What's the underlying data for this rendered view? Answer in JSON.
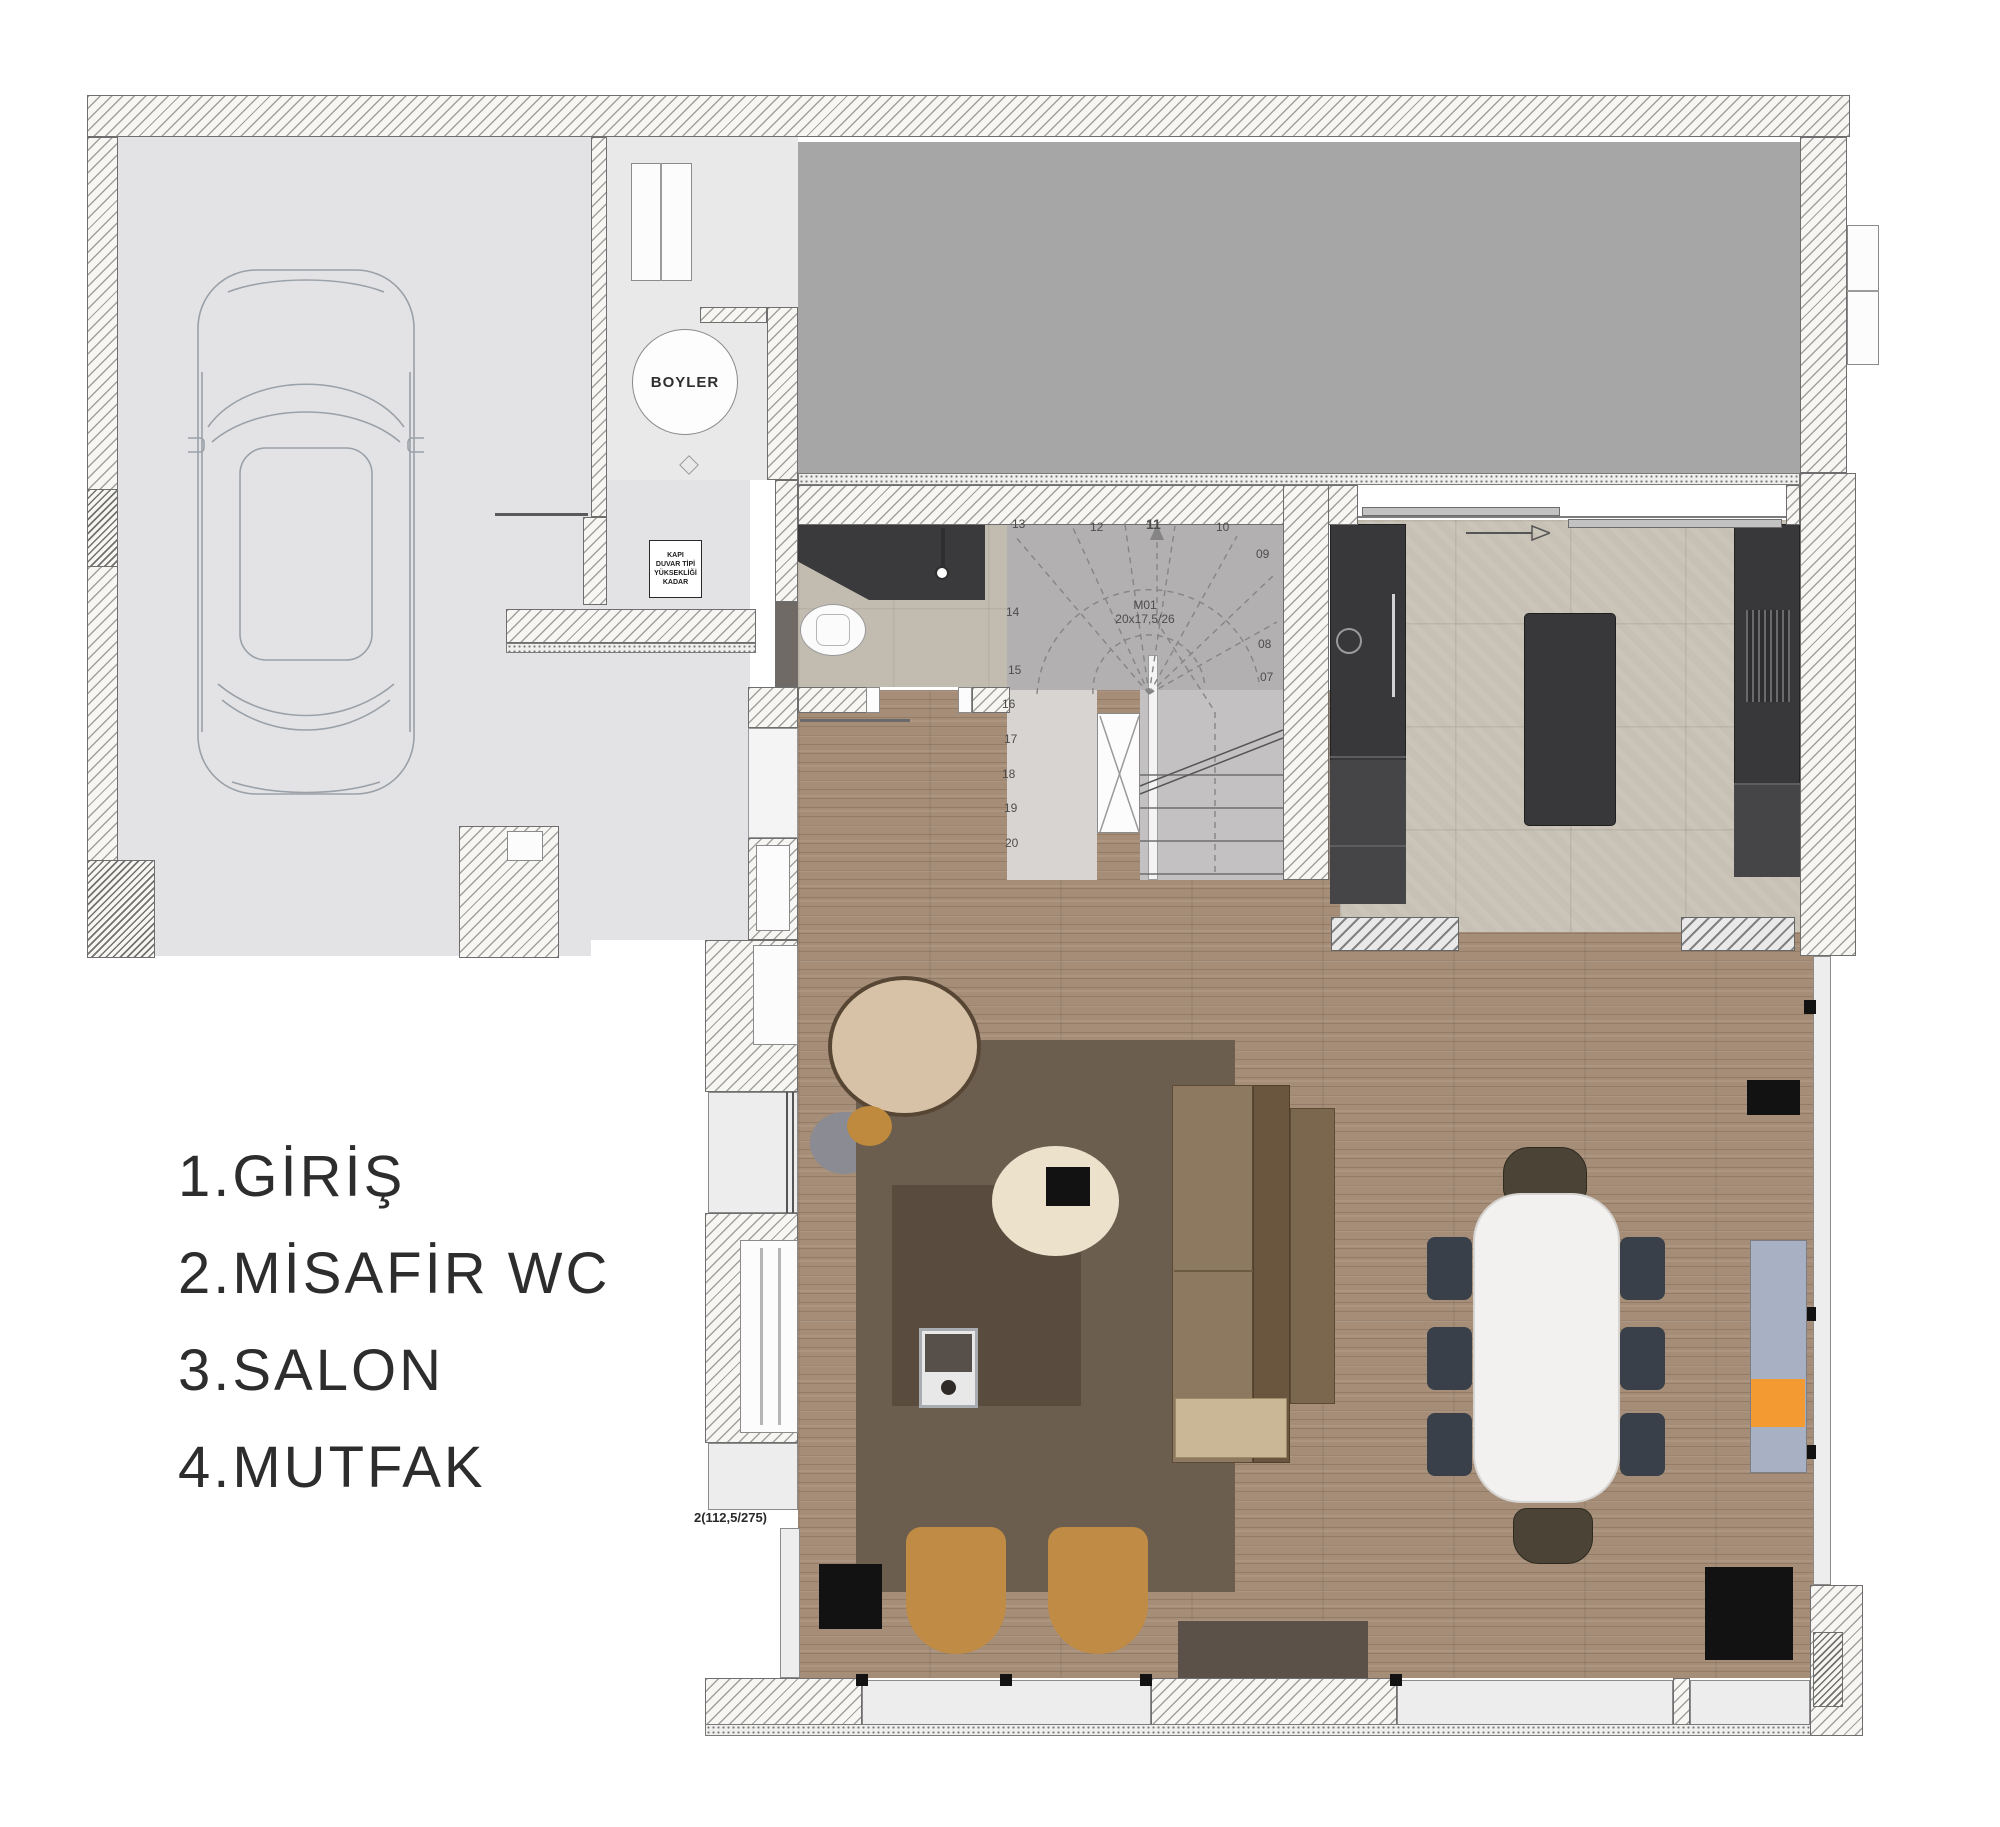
{
  "legend": {
    "items": [
      "1.GİRİŞ",
      "2.MİSAFİR WC",
      "3.SALON",
      "4.MUTFAK"
    ]
  },
  "boiler": {
    "label": "BOYLER"
  },
  "stairs": {
    "unit": "M01",
    "spec": "20x17,5/26",
    "numbers": [
      "13",
      "12",
      "11",
      "10",
      "09",
      "08",
      "07",
      "14",
      "15",
      "16",
      "17",
      "18",
      "19",
      "20"
    ]
  },
  "windows": {
    "west_label": "2(112,5/275)"
  },
  "wc_note": {
    "lines": [
      "KAPI",
      "DUVAR TİPİ",
      "YÜKSEKLİĞİ",
      "KADAR"
    ]
  },
  "colors": {
    "terrace": "#a7a6a6",
    "garage_floor": "#e3e3e5",
    "wood_floor": "#a58d77",
    "stone_floor": "#c7c1b5",
    "cabinet_dark": "#38383a",
    "rug": "#6b5e4f",
    "rug_inner": "#594b3e",
    "sofa": "#8d7960",
    "accent_orange": "#f49a33",
    "sideboard_blue": "#a8b1c3",
    "stool": "#c08b44",
    "chair_navy": "#394049",
    "dining_table": "#f2f1ef"
  }
}
